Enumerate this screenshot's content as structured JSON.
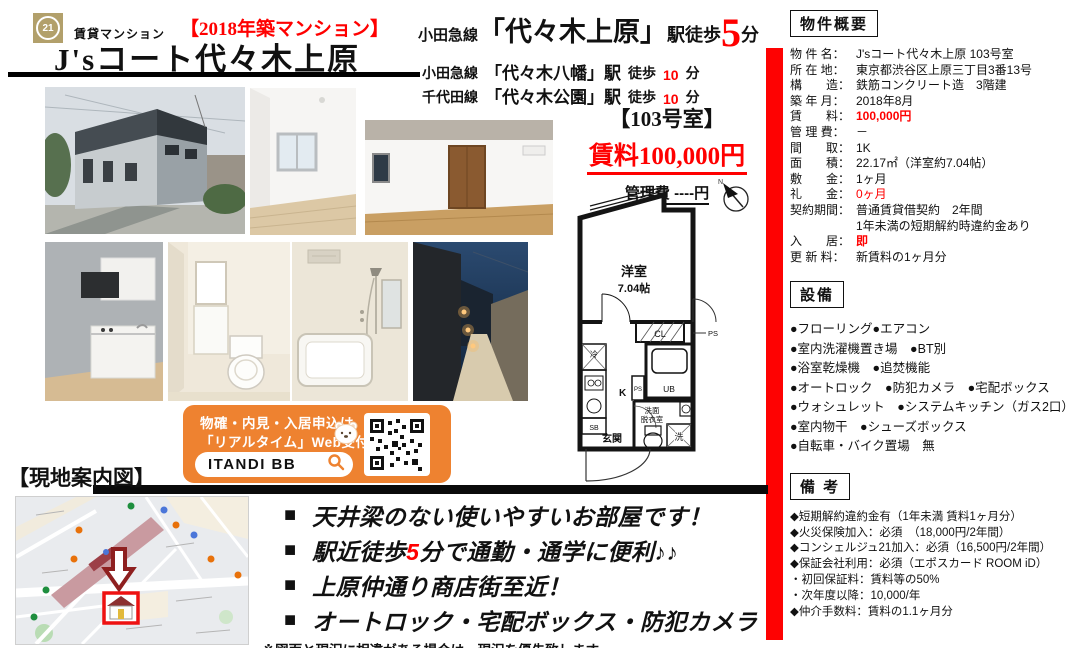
{
  "colors": {
    "accent_red": "#ff0000",
    "banner_orange": "#ee8230",
    "logo_gold": "#b2a06b"
  },
  "header": {
    "logo_text": "21",
    "category": "賃貸マンション",
    "year_badge": "【2018年築マンション】",
    "title": "J'sコート代々木上原"
  },
  "access": {
    "main": {
      "line": "小田急線",
      "station": "「代々木上原」",
      "suffix": "駅徒歩",
      "minutes": "5",
      "unit": "分"
    },
    "sub": [
      {
        "line": "小田急線",
        "station": "「代々木八幡」駅",
        "walk": "徒歩",
        "minutes": "10",
        "unit": "分"
      },
      {
        "line": "千代田線",
        "station": "「代々木公園」駅",
        "walk": "徒歩",
        "minutes": "10",
        "unit": "分"
      }
    ]
  },
  "unit": {
    "room_no": "【103号室】",
    "rent": "賃料100,000円",
    "management_fee": "管理費 ----円"
  },
  "floorplan": {
    "labels": {
      "room_type": "洋室",
      "room_size": "7.04帖",
      "closet": "CL",
      "ps": "PS",
      "ps_small": "PS",
      "fridge": "冷",
      "kitchen": "K",
      "bath": "UB",
      "washroom_line1": "洗面",
      "washroom_line2": "脱衣室",
      "entrance": "玄関",
      "laundry": "洗",
      "shoe_box": "SB",
      "north": "N"
    }
  },
  "banner": {
    "line1": "物確・内見・入居申込は",
    "line2": "「リアルタイム」Web受付",
    "brand": "ITANDI BB"
  },
  "map_section": {
    "heading": "【現地案内図】"
  },
  "highlights": {
    "marker": "■",
    "items": [
      {
        "pre": "天井梁のない使いやすいお部屋です！",
        "hi": "",
        "post": ""
      },
      {
        "pre": "駅近徒歩",
        "hi": "5",
        "post": "分で通勤・通学に便利♪♪"
      },
      {
        "pre": "上原仲通り商店街至近！",
        "hi": "",
        "post": ""
      },
      {
        "pre": "オートロック・宅配ボックス・防犯カメラ",
        "hi": "",
        "post": ""
      }
    ],
    "note": "※図面と現況に相違がある場合は、現況を優先致します。"
  },
  "overview": {
    "heading": "物件概要",
    "rows": [
      {
        "label": "物 件 名：",
        "value": "J'sコート代々木上原 103号室"
      },
      {
        "label": "所 在 地：",
        "value": "東京都渋谷区上原三丁目3番13号"
      },
      {
        "label": "構　　造：",
        "value": "鉄筋コンクリート造　3階建"
      },
      {
        "label": "築 年 月：",
        "value": "2018年8月"
      },
      {
        "label": "賃　　料：",
        "value": "100,000円"
      },
      {
        "label": "管 理 費：",
        "value": "－"
      },
      {
        "label": "間　　取：",
        "value": "1K"
      },
      {
        "label": "面　　積：",
        "value": "22.17㎡（洋室約7.04帖）"
      },
      {
        "label": "敷　　金：",
        "value": "1ヶ月"
      },
      {
        "label": "礼　　金：",
        "value": "0ヶ月"
      },
      {
        "label": "契約期間：",
        "value": "普通賃貸借契約　2年間"
      },
      {
        "label": "",
        "value": "1年未満の短期解約時違約金あり"
      },
      {
        "label": "入　　居：",
        "value": "即"
      },
      {
        "label": "更 新 料：",
        "value": "新賃料の1ヶ月分"
      }
    ]
  },
  "equipment": {
    "heading": "設備",
    "items": [
      "●フローリング●エアコン",
      "●室内洗濯機置き場　●BT別",
      "●浴室乾燥機　●追焚機能",
      "●オートロック　●防犯カメラ　●宅配ボックス",
      "●ウォシュレット　●システムキッチン（ガス2口）",
      "●室内物干　●シューズボックス",
      "●自転車・バイク置場　無"
    ]
  },
  "remarks": {
    "heading": "備 考",
    "items": [
      "◆短期解約違約金有（1年未満 賃料1ヶ月分）",
      "◆火災保険加入：必須　（18,000円/2年間）",
      "◆コンシェルジュ21加入：必須（16,500円/2年間）",
      "◆保証会社利用：必須（エポスカード ROOM iD）",
      "・初回保証料：賃料等の50%",
      "・次年度以降：10,000/年",
      "◆仲介手数料：賃料の1.1ヶ月分"
    ]
  }
}
